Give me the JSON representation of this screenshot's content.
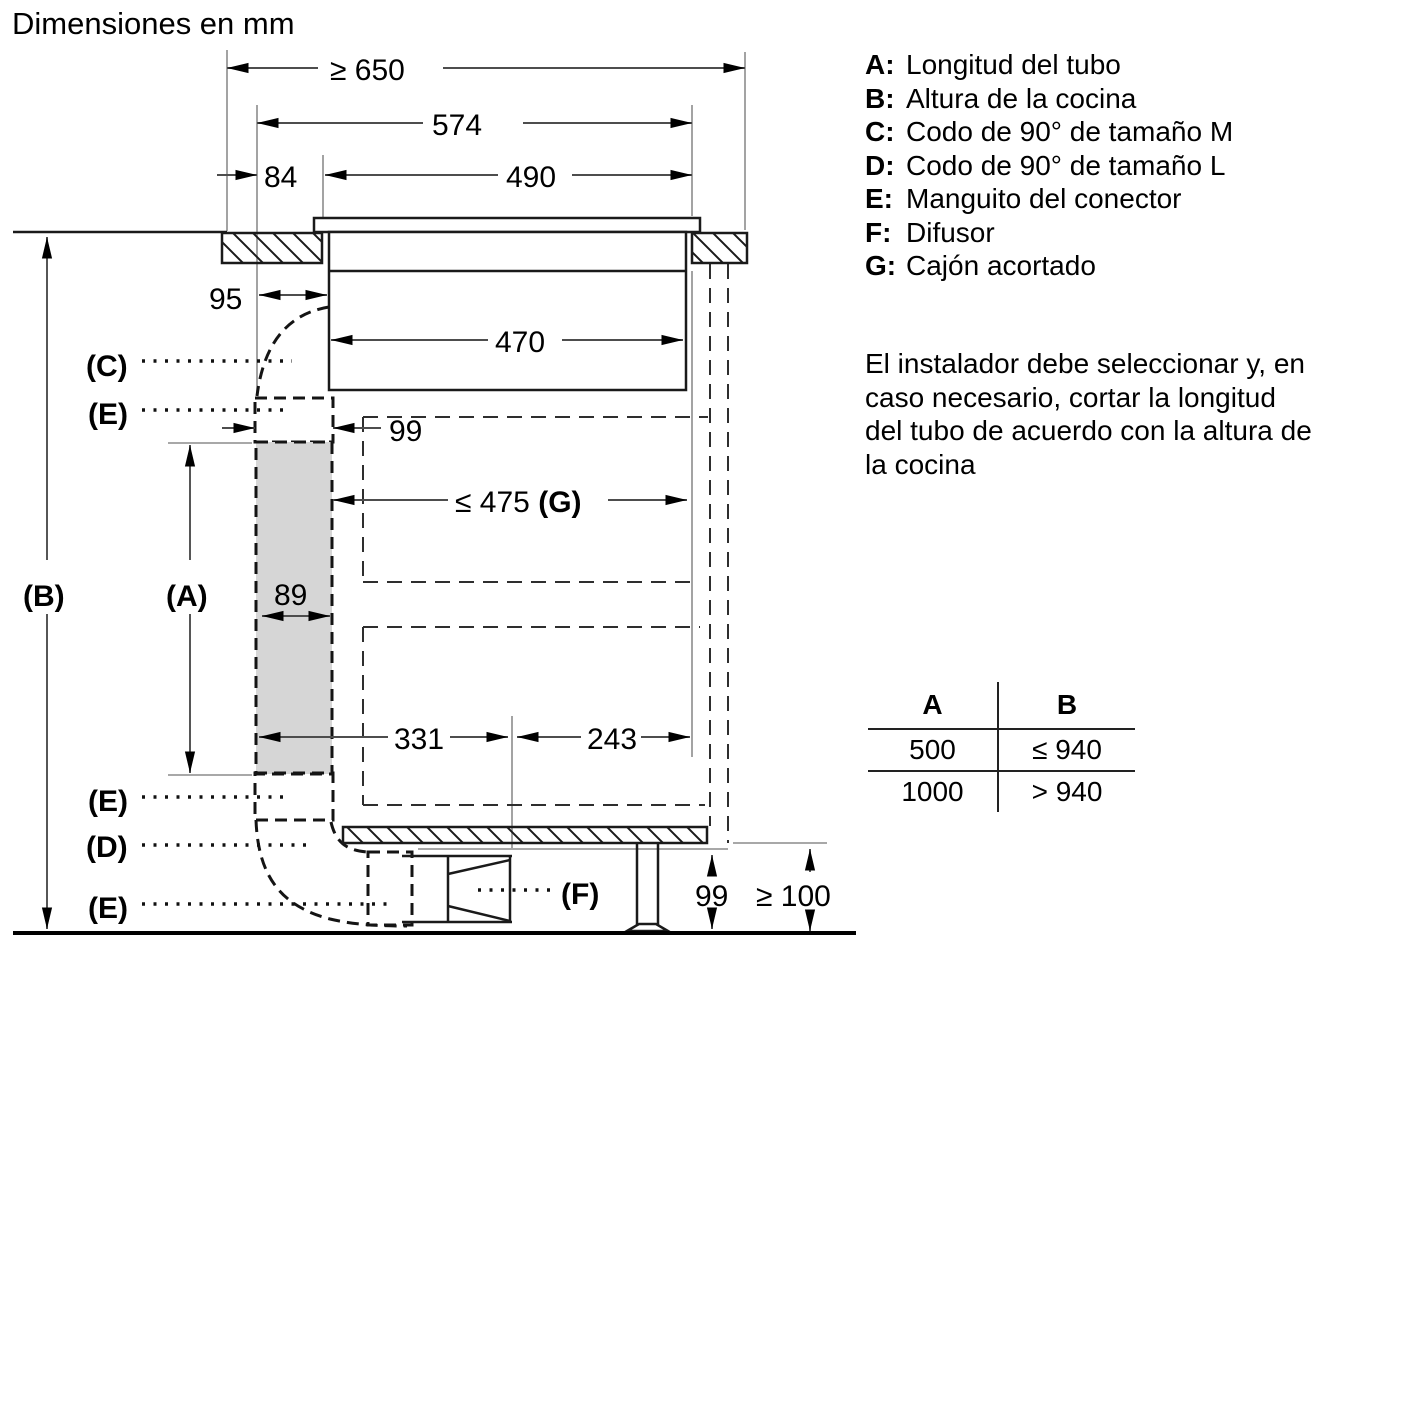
{
  "title": "Dimensiones en mm",
  "diagram": {
    "dims": {
      "top_width": "≥ 650",
      "hob_width": "574",
      "offset_84": "84",
      "cutout_490": "490",
      "offset_95": "95",
      "body_470": "470",
      "sleeve_99": "99",
      "drawer_475": "≤ 475",
      "drawer_g": "(G)",
      "tube_89": "89",
      "left_331": "331",
      "right_243": "243",
      "bottom_99": "99",
      "clearance_100": "≥ 100"
    },
    "labels": {
      "a": "(A)",
      "b": "(B)",
      "c": "(C)",
      "d": "(D)",
      "e_top": "(E)",
      "e_mid": "(E)",
      "e_bottom": "(E)",
      "f": "(F)"
    }
  },
  "legend": {
    "items": [
      {
        "key": "A:",
        "text": "Longitud del tubo"
      },
      {
        "key": "B:",
        "text": "Altura de la cocina"
      },
      {
        "key": "C:",
        "text": "Codo de 90° de tamaño M"
      },
      {
        "key": "D:",
        "text": "Codo de 90° de tamaño L"
      },
      {
        "key": "E:",
        "text": "Manguito del conector"
      },
      {
        "key": "F:",
        "text": "Difusor"
      },
      {
        "key": "G:",
        "text": "Cajón acortado"
      }
    ]
  },
  "note": {
    "lines": [
      "El instalador debe seleccionar y, en",
      "caso necesario, cortar la longitud",
      "del tubo de acuerdo con la altura de",
      "la cocina"
    ]
  },
  "table": {
    "headers": [
      "A",
      "B"
    ],
    "rows": [
      [
        "500",
        "≤ 940"
      ],
      [
        "1000",
        "> 940"
      ]
    ]
  }
}
